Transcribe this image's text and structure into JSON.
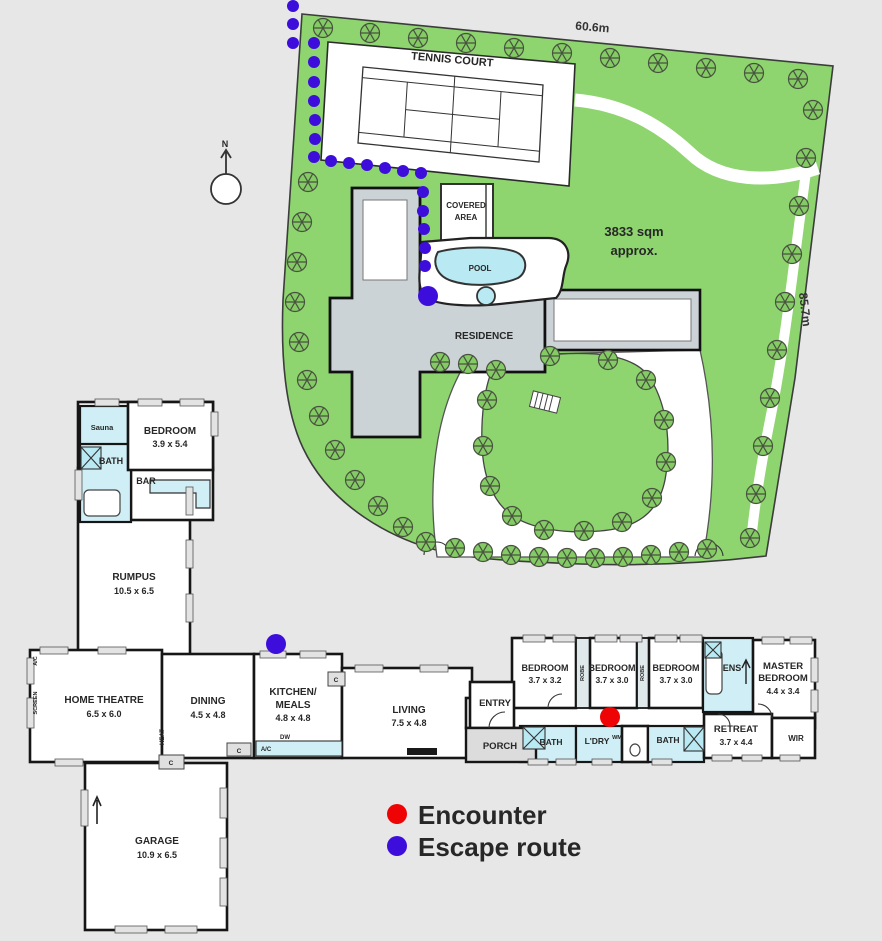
{
  "site": {
    "dim_top": "60.6m",
    "dim_right": "85.7m",
    "area_line1": "3833 sqm",
    "area_line2": "approx.",
    "tennis_court": "TENNIS COURT",
    "covered_line1": "COVERED",
    "covered_line2": "AREA",
    "pool": "POOL",
    "residence": "RESIDENCE",
    "north_label": "N"
  },
  "rooms": {
    "bedroom_tl": {
      "name": "BEDROOM",
      "dims": "3.9 x 5.4"
    },
    "sauna": {
      "name": "Sauna"
    },
    "bath_tl": {
      "name": "BATH"
    },
    "bar": {
      "name": "BAR"
    },
    "rumpus": {
      "name": "RUMPUS",
      "dims": "10.5 x 6.5"
    },
    "home_theatre": {
      "name": "HOME THEATRE",
      "dims": "6.5 x 6.0"
    },
    "dining": {
      "name": "DINING",
      "dims": "4.5 x 4.8"
    },
    "kitchen": {
      "line1": "KITCHEN/",
      "line2": "MEALS",
      "dims": "4.8 x 4.8"
    },
    "living": {
      "name": "LIVING",
      "dims": "7.5 x 4.8"
    },
    "entry": {
      "name": "ENTRY"
    },
    "porch": {
      "name": "PORCH"
    },
    "bedroom1": {
      "name": "BEDROOM",
      "dims": "3.7 x 3.2"
    },
    "bedroom2": {
      "name": "BEDROOM",
      "dims": "3.7 x 3.0"
    },
    "bedroom3": {
      "name": "BEDROOM",
      "dims": "3.7 x 3.0"
    },
    "ens": {
      "name": "ENS"
    },
    "master": {
      "line1": "MASTER",
      "line2": "BEDROOM",
      "dims": "4.4 x 3.4"
    },
    "bath": {
      "name": "BATH"
    },
    "ldry": {
      "name": "L'DRY"
    },
    "retreat": {
      "name": "RETREAT",
      "dims": "3.7 x 4.4"
    },
    "wir": {
      "name": "WIR"
    },
    "garage": {
      "name": "GARAGE",
      "dims": "10.9 x 6.5"
    },
    "labels": {
      "c": "C",
      "ac": "A/C",
      "dw": "DW",
      "wm": "WM",
      "heat": "HEAT",
      "screen": "SCREEN",
      "robe": "ROBE"
    }
  },
  "legend": {
    "encounter": {
      "label": "Encounter",
      "color": "#ee0404"
    },
    "escape": {
      "label": "Escape route",
      "color": "#3d0edb"
    }
  },
  "annotations": {
    "encounter_dots": [
      [
        610,
        717,
        10
      ]
    ],
    "escape_dots": [
      [
        293,
        6,
        6
      ],
      [
        293,
        24,
        6
      ],
      [
        293,
        43,
        6
      ],
      [
        314,
        43,
        6
      ],
      [
        314,
        62,
        6
      ],
      [
        314,
        82,
        6
      ],
      [
        314,
        101,
        6
      ],
      [
        315,
        120,
        6
      ],
      [
        315,
        139,
        6
      ],
      [
        314,
        157,
        6
      ],
      [
        331,
        161,
        6
      ],
      [
        349,
        163,
        6
      ],
      [
        367,
        165,
        6
      ],
      [
        385,
        168,
        6
      ],
      [
        403,
        171,
        6
      ],
      [
        421,
        173,
        6
      ],
      [
        423,
        192,
        6
      ],
      [
        423,
        211,
        6
      ],
      [
        424,
        229,
        6
      ],
      [
        425,
        248,
        6
      ],
      [
        425,
        266,
        6
      ],
      [
        428,
        296,
        10
      ],
      [
        276,
        644,
        10
      ]
    ]
  }
}
